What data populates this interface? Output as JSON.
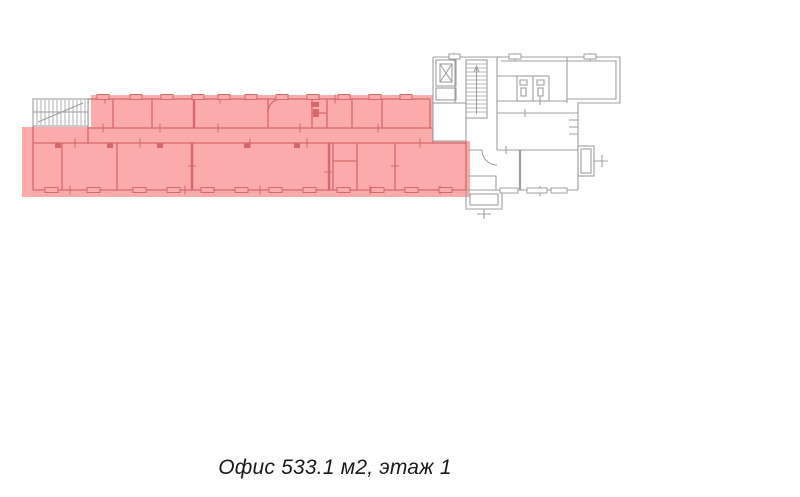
{
  "caption": {
    "text": "Офис 533.1 м2, этаж 1"
  },
  "colors": {
    "background": "#ffffff",
    "highlight_fill": "#fbabab",
    "highlight_wall": "#d5686a",
    "wall_gray": "#9f9f9f",
    "caption_text": "#1b1b1b"
  }
}
